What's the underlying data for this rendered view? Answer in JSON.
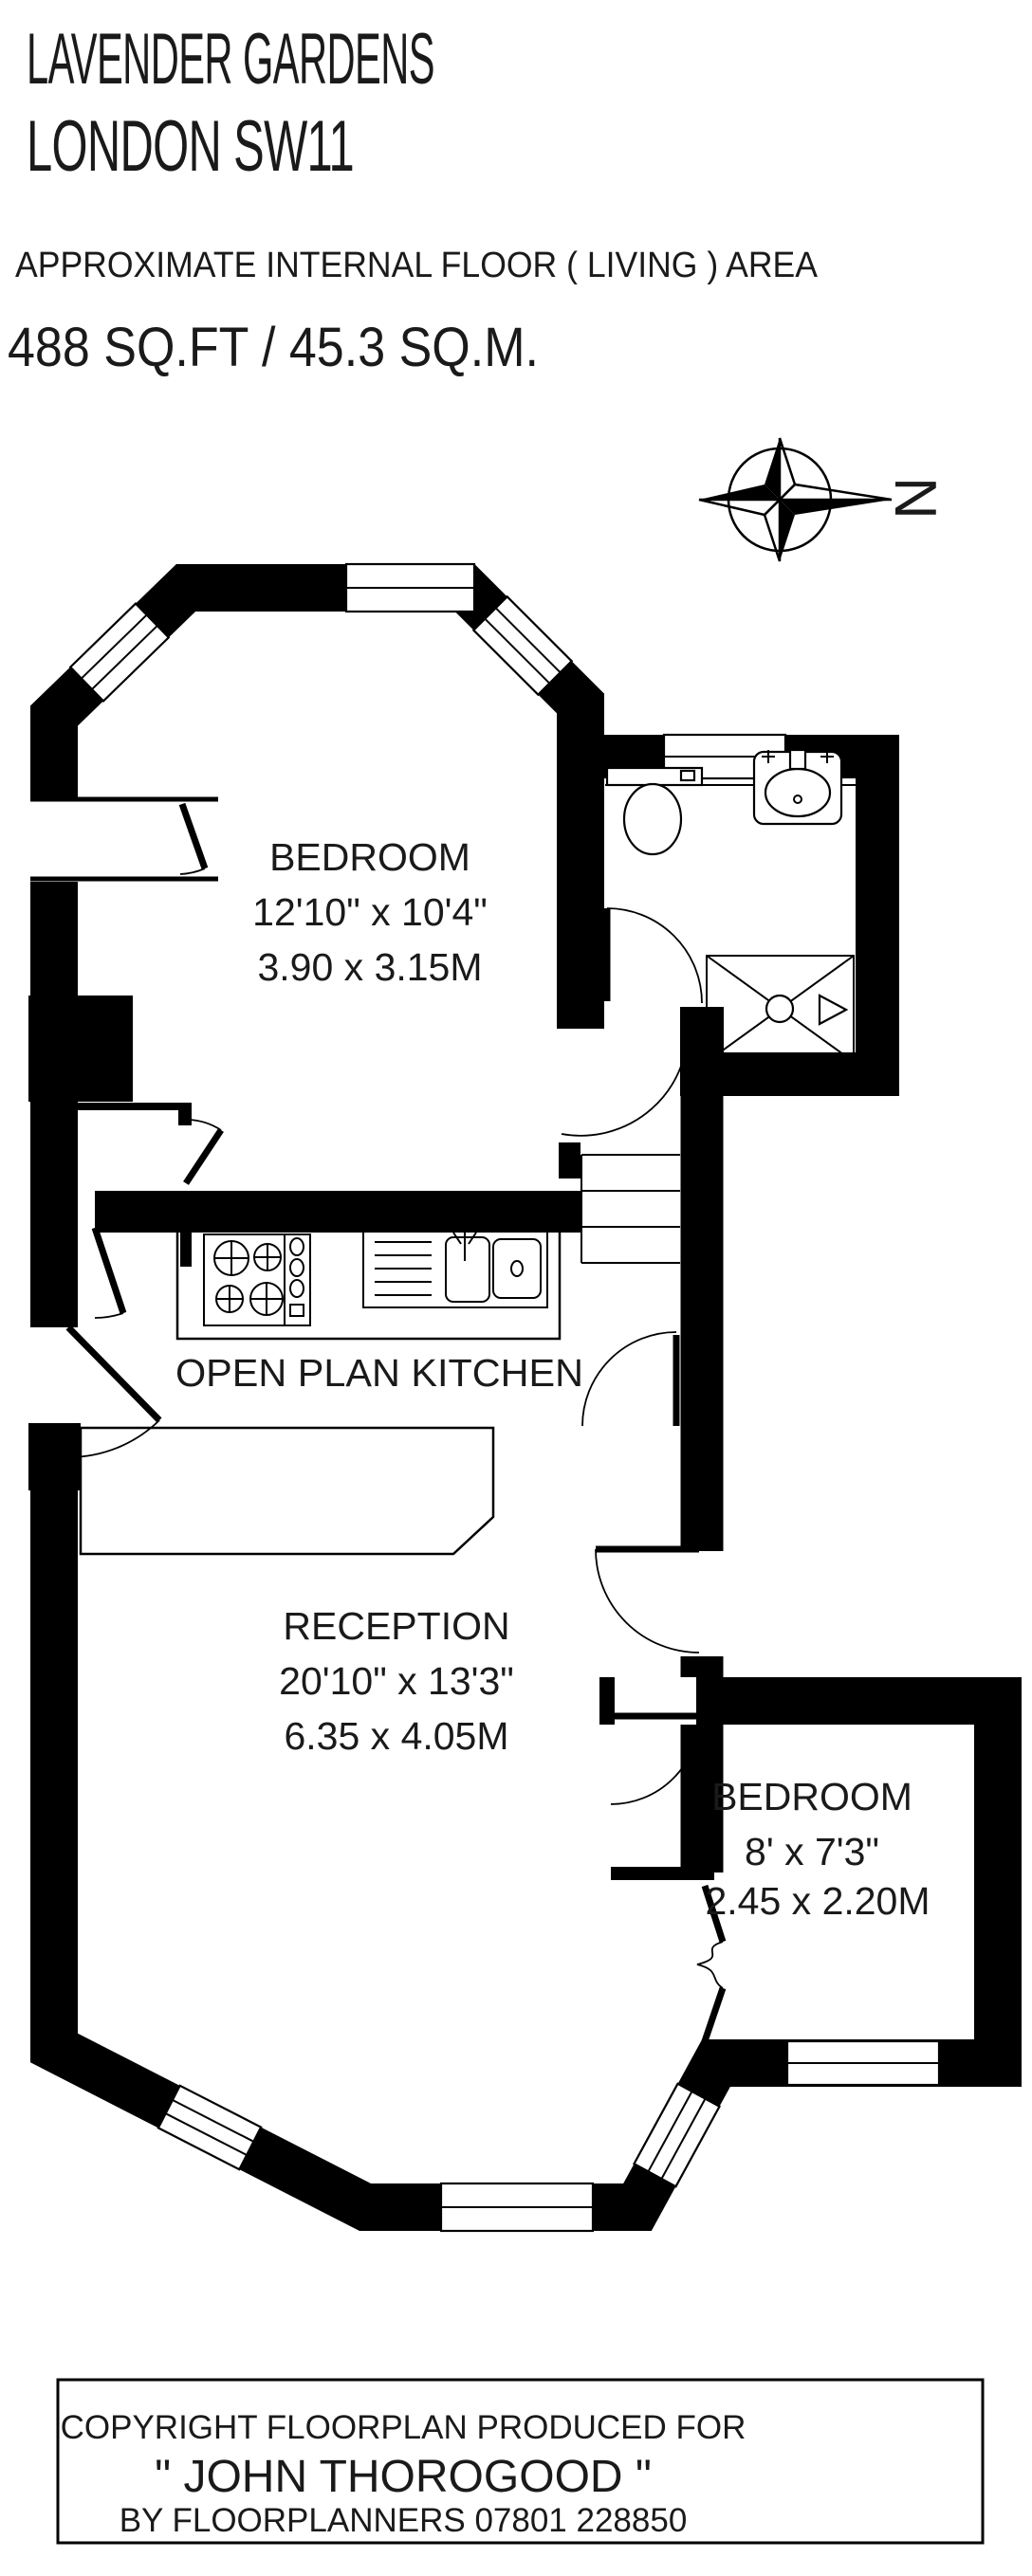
{
  "header": {
    "title_line1": "LAVENDER GARDENS",
    "title_line2": "LONDON SW11",
    "subtitle": "APPROXIMATE INTERNAL FLOOR ( LIVING ) AREA",
    "area": "488 SQ.FT / 45.3 SQ.M."
  },
  "compass": {
    "north_label": "N"
  },
  "rooms": {
    "bedroom1": {
      "name": "BEDROOM",
      "imperial": "12'10\" x 10'4\"",
      "metric": "3.90 x 3.15M"
    },
    "kitchen": {
      "name": "OPEN PLAN KITCHEN"
    },
    "reception": {
      "name": "RECEPTION",
      "imperial": "20'10\" x 13'3\"",
      "metric": "6.35 x 4.05M"
    },
    "bedroom2": {
      "name": "BEDROOM",
      "imperial": "8' x 7'3\"",
      "metric": "2.45 x 2.20M"
    }
  },
  "fixtures": {
    "bathroom": [
      "toilet-icon",
      "basin-icon",
      "shower-icon"
    ],
    "kitchen": [
      "hob-icon",
      "kitchen-sink-icon"
    ],
    "hall": [
      "stairs-icon"
    ]
  },
  "footer": {
    "line1": "COPYRIGHT FLOORPLAN PRODUCED FOR",
    "line2": "\" JOHN THOROGOOD \"",
    "line3": "BY FLOORPLANNERS 07801 228850"
  },
  "colors": {
    "ink": "#000000",
    "paper": "#ffffff"
  }
}
